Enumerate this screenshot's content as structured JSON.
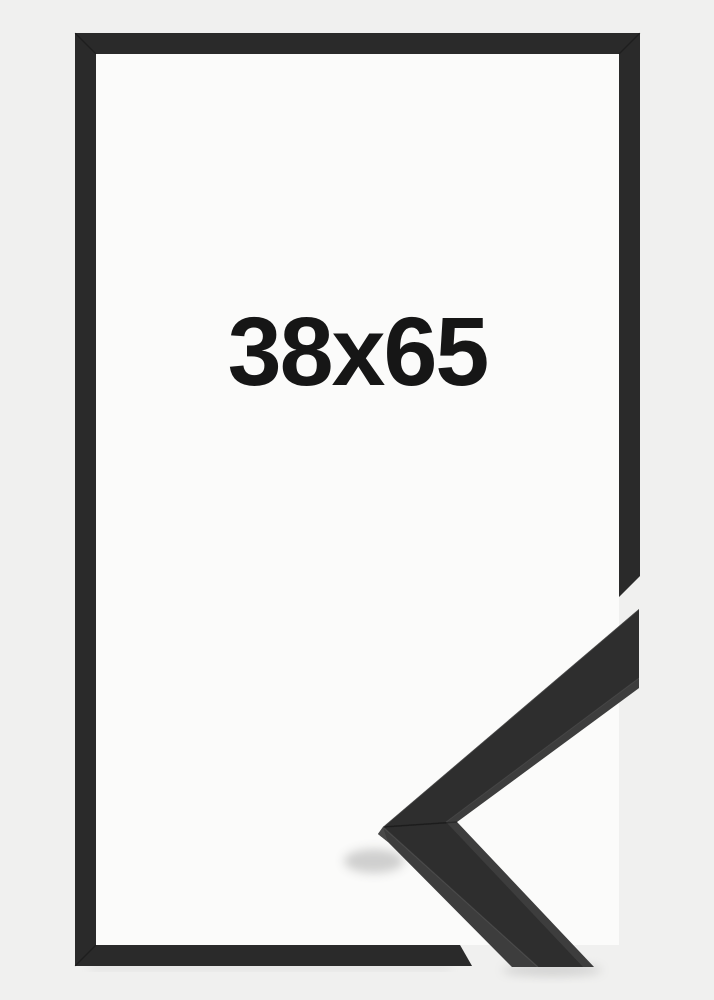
{
  "product": {
    "size_label": "38x65",
    "frame_style": "black-flat-moulding",
    "colors": {
      "background": "#f0f0ef",
      "mat": "#fbfbfa",
      "frame_bar": "#2b2b2b",
      "sample_face": "#2d2d2d",
      "sample_side": "#3c3c3c",
      "sample_tip_facet": "#4a4a4a",
      "label_text": "#161616"
    }
  }
}
